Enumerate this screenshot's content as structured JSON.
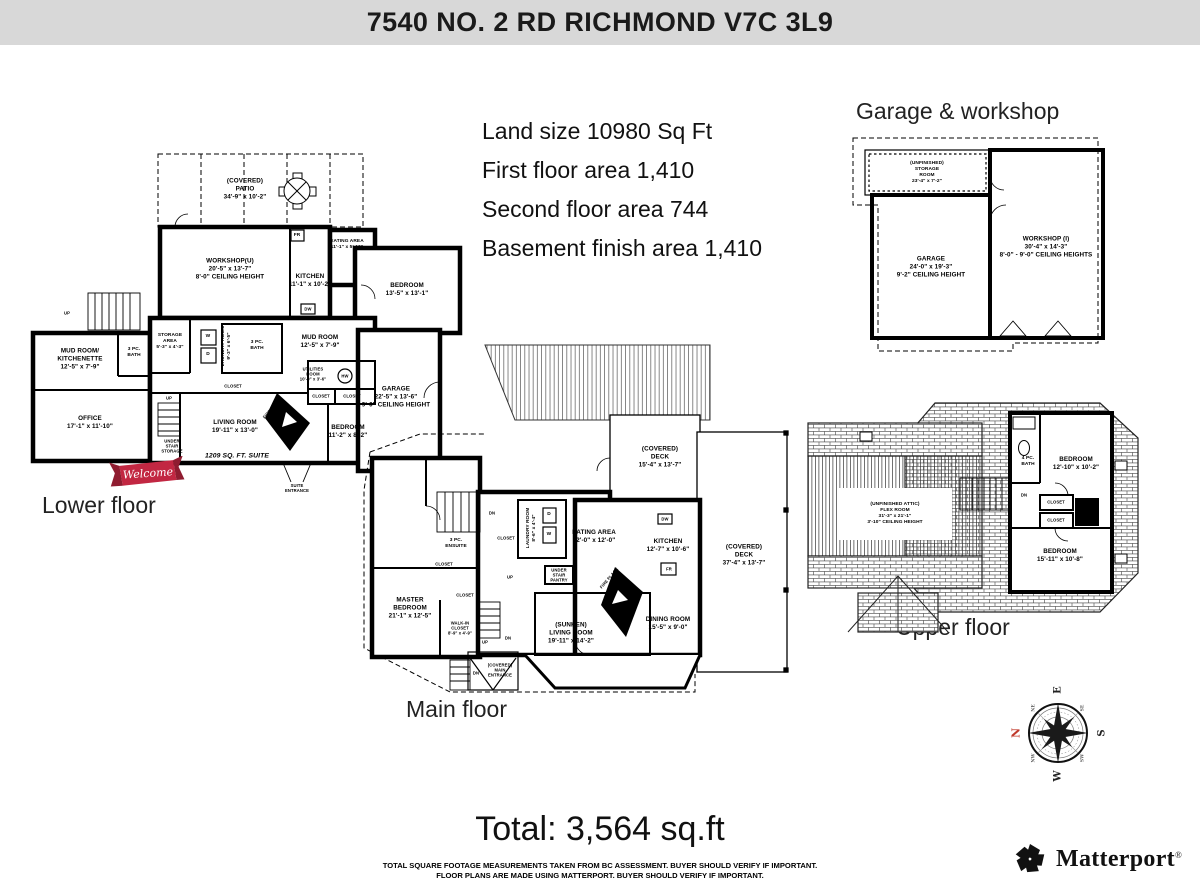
{
  "header": {
    "title": "7540 NO. 2 RD RICHMOND V7C 3L9"
  },
  "summary": {
    "lines": [
      "Land size 10980 Sq Ft",
      "First floor area 1,410",
      "Second floor area 744",
      "Basement finish area 1,410"
    ]
  },
  "sections": {
    "garage_workshop": "Garage & workshop",
    "lower": "Lower floor",
    "main": "Main floor",
    "upper": "Upper floor"
  },
  "labels": {
    "closet": "CLOSET",
    "fireplace": "FIRE PLACE",
    "up": "UP",
    "down": "DN",
    "welcome": "Welcome",
    "suite_area": "1209 SQ. FT. SUITE",
    "suite_entrance": [
      "SUITE",
      "ENTRANCE"
    ],
    "main_entrance": [
      "(COVERED)",
      "MAIN",
      "ENTRANCE"
    ]
  },
  "appliances": {
    "fridge": "FR",
    "dishwasher": "DW",
    "washer": "W",
    "dryer": "D",
    "hot_water": "HW"
  },
  "plans": {
    "lower": {
      "rooms": {
        "patio": [
          "(COVERED)",
          "PATIO",
          "34'-9\" x 10'-2\""
        ],
        "workshop": [
          "WORKSHOP(U)",
          "20'-5\" x 13'-7\"",
          "8'-0\" CEILING HEIGHT"
        ],
        "eating": [
          "EATING AREA",
          "11'-1\" x 5'-10\""
        ],
        "kitchen": [
          "KITCHEN",
          "11'-1\" x 10'-2\""
        ],
        "bedroom1": [
          "BEDROOM",
          "13'-5\" x 13'-1\""
        ],
        "storage": [
          "STORAGE",
          "AREA",
          "5'-3\" x 4'-3\""
        ],
        "laundry": [
          "LAUNDRY ROOM",
          "9'-3\" x 6'-5\""
        ],
        "bath_center": [
          "3 PC.",
          "BATH"
        ],
        "mudroom": [
          "MUD ROOM",
          "12'-5\" x 7'-9\""
        ],
        "mud_kitchenette": [
          "MUD ROOM/",
          "KITCHENETTE",
          "12'-5\" x 7'-9\""
        ],
        "bath_left": [
          "3 PC.",
          "BATH"
        ],
        "office": [
          "OFFICE",
          "17'-1\" x 11'-10\""
        ],
        "under_stair": [
          "UNDER",
          "STAIR",
          "STORAGE"
        ],
        "living": [
          "LIVING ROOM",
          "19'-11\" x 13'-0\""
        ],
        "utilities": [
          "UTILITIES",
          "ROOM",
          "10'-0\" x 3'-6\""
        ],
        "bedroom2": [
          "BEDROOM",
          "11'-2\" x 8'-2\""
        ],
        "garage": [
          "GARAGE",
          "22'-5\" x 13'-6\"",
          "9'-0\" CEILING HEIGHT"
        ]
      }
    },
    "main": {
      "rooms": {
        "deck_small": [
          "(COVERED)",
          "DECK",
          "15'-4\" x 13'-7\""
        ],
        "deck_large": [
          "(COVERED)",
          "DECK",
          "37'-4\" x 13'-7\""
        ],
        "laundry": [
          "LAUNDRY ROOM",
          "8'-6\" x 4'-4\""
        ],
        "eating": [
          "EATING AREA",
          "12'-0\" x 12'-0\""
        ],
        "kitchen": [
          "KITCHEN",
          "12'-7\" x 10'-6\""
        ],
        "ensuite": [
          "3 PC.",
          "ENSUITE"
        ],
        "master": [
          "MASTER",
          "BEDROOM",
          "21'-1\" x 12'-5\""
        ],
        "walk_in": [
          "WALK-IN",
          "CLOSET",
          "8'-9\" x 4'-9\""
        ],
        "pantry": [
          "UNDER",
          "STAIR",
          "PANTRY"
        ],
        "living": [
          "(SUNKEN)",
          "LIVING ROOM",
          "19'-11\" x 14'-2\""
        ],
        "dining": [
          "DINING ROOM",
          "15'-5\" x 9'-0\""
        ]
      }
    },
    "upper": {
      "rooms": {
        "flex": [
          "(UNFINISHED ATTIC)",
          "FLEX ROOM",
          "31'-3\" x 21'-1\"",
          "3'-10\" CEILING HEIGHT"
        ],
        "bath": [
          "4 PC.",
          "BATH"
        ],
        "bedroom1": [
          "BEDROOM",
          "12'-10\" x 10'-2\""
        ],
        "bedroom2": [
          "BEDROOM",
          "15'-11\" x 10'-8\""
        ]
      }
    },
    "garage_workshop": {
      "rooms": {
        "storage": [
          "(UNFINISHED)",
          "STORAGE",
          "ROOM",
          "23'-4\" x 7'-2\""
        ],
        "garage": [
          "GARAGE",
          "24'-0\" x 19'-3\"",
          "9'-2\" CEILING HEIGHT"
        ],
        "workshop": [
          "WORKSHOP (I)",
          "30'-4\" x 14'-3\"",
          "8'-0\" - 9'-0\" CEILING HEIGHTS"
        ]
      }
    }
  },
  "compass": {
    "cardinals": [
      "N",
      "E",
      "S",
      "W"
    ],
    "intercardinals": [
      "NE",
      "SE",
      "SW",
      "NW"
    ],
    "north_color": "#c0392b"
  },
  "total": {
    "text": "Total: 3,564 sq.ft"
  },
  "footer": {
    "lines": [
      "TOTAL SQUARE FOOTAGE MEASUREMENTS TAKEN FROM BC ASSESSMENT. BUYER SHOULD VERIFY IF IMPORTANT.",
      "FLOOR PLANS ARE MADE USING MATTERPORT. BUYER SHOULD VERIFY IF IMPORTANT."
    ]
  },
  "logo": {
    "text": "Matterport",
    "mark": "®"
  },
  "colors": {
    "header_bg": "#d8d8d8",
    "ribbon_red": "#c22742",
    "line": "#000000"
  }
}
